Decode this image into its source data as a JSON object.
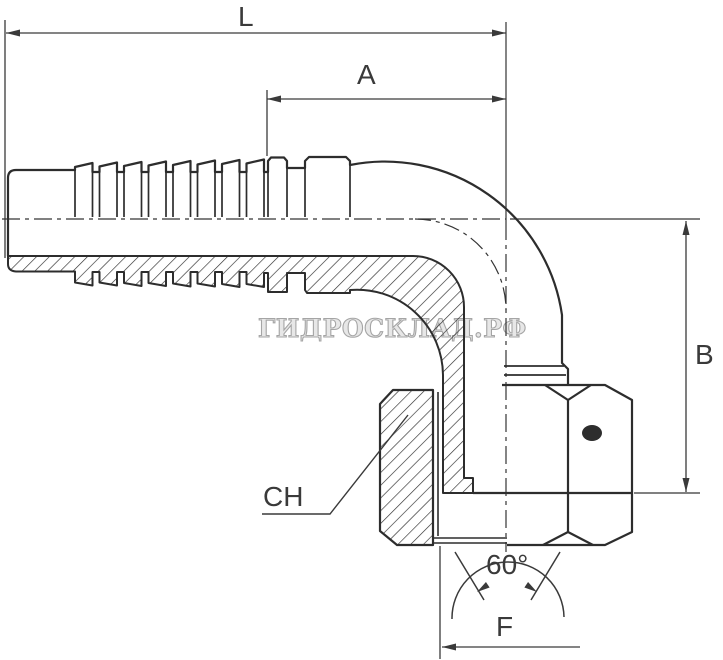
{
  "page": {
    "background": "#ffffff"
  },
  "dimension_labels": {
    "L": "L",
    "A": "A",
    "B": "B",
    "CH": "CH",
    "F": "F",
    "cone_angle": "60°"
  },
  "watermark": {
    "text": "ГИДРОСКЛАД.РФ",
    "color": "#8f8f8f"
  },
  "colors": {
    "outline": "#2d2d2d",
    "dimension_lines": "#3a3a3a",
    "label_text": "#3a3a3a",
    "hatch": "#2d2d2d"
  }
}
